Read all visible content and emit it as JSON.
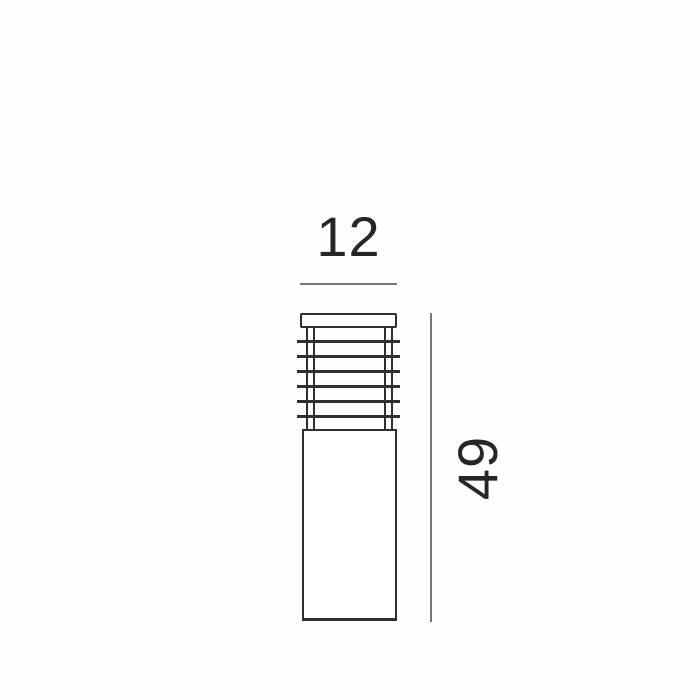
{
  "drawing": {
    "width_label": "12",
    "height_label": "49",
    "louver": {
      "slat_count": 6,
      "slat_start_top": 12,
      "slat_spacing": 15
    },
    "colors": {
      "outline": "#2f2f2f",
      "dimension_line": "#767676",
      "label_text": "#262626",
      "background": "#fefefe"
    }
  }
}
